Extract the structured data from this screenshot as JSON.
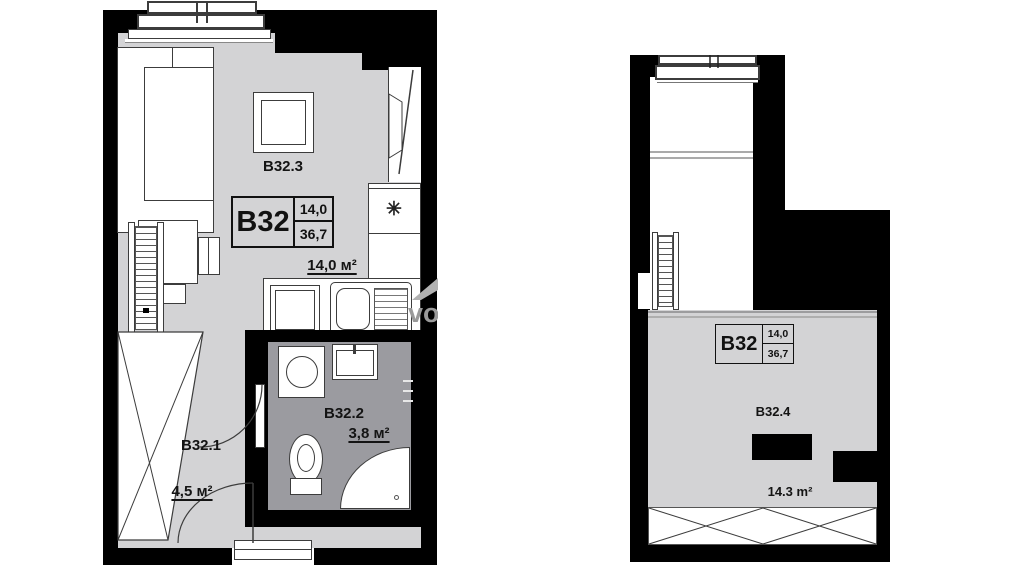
{
  "watermark": {
    "text": "vo"
  },
  "left_plan": {
    "info_box": {
      "unit": "B32",
      "value_top": "14,0",
      "value_bottom": "36,7"
    },
    "living_room": {
      "id": "B32.3",
      "area": "14,0 м²"
    },
    "hallway": {
      "id": "B32.1",
      "area": "4,5 м²"
    },
    "bathroom": {
      "id": "B32.2",
      "area": "3,8 м²"
    },
    "fridge_symbol": "✳"
  },
  "right_plan": {
    "info_box": {
      "unit": "B32",
      "value_top": "14,0",
      "value_bottom": "36,7"
    },
    "mezzanine": {
      "id": "B32.4",
      "area": "14.3 m²"
    }
  },
  "colors": {
    "wall": "#000000",
    "floor": "#d3d3d5",
    "bathroom_floor": "#9b9ba0",
    "text": "#141414",
    "watermark": "#9a9a9a"
  }
}
